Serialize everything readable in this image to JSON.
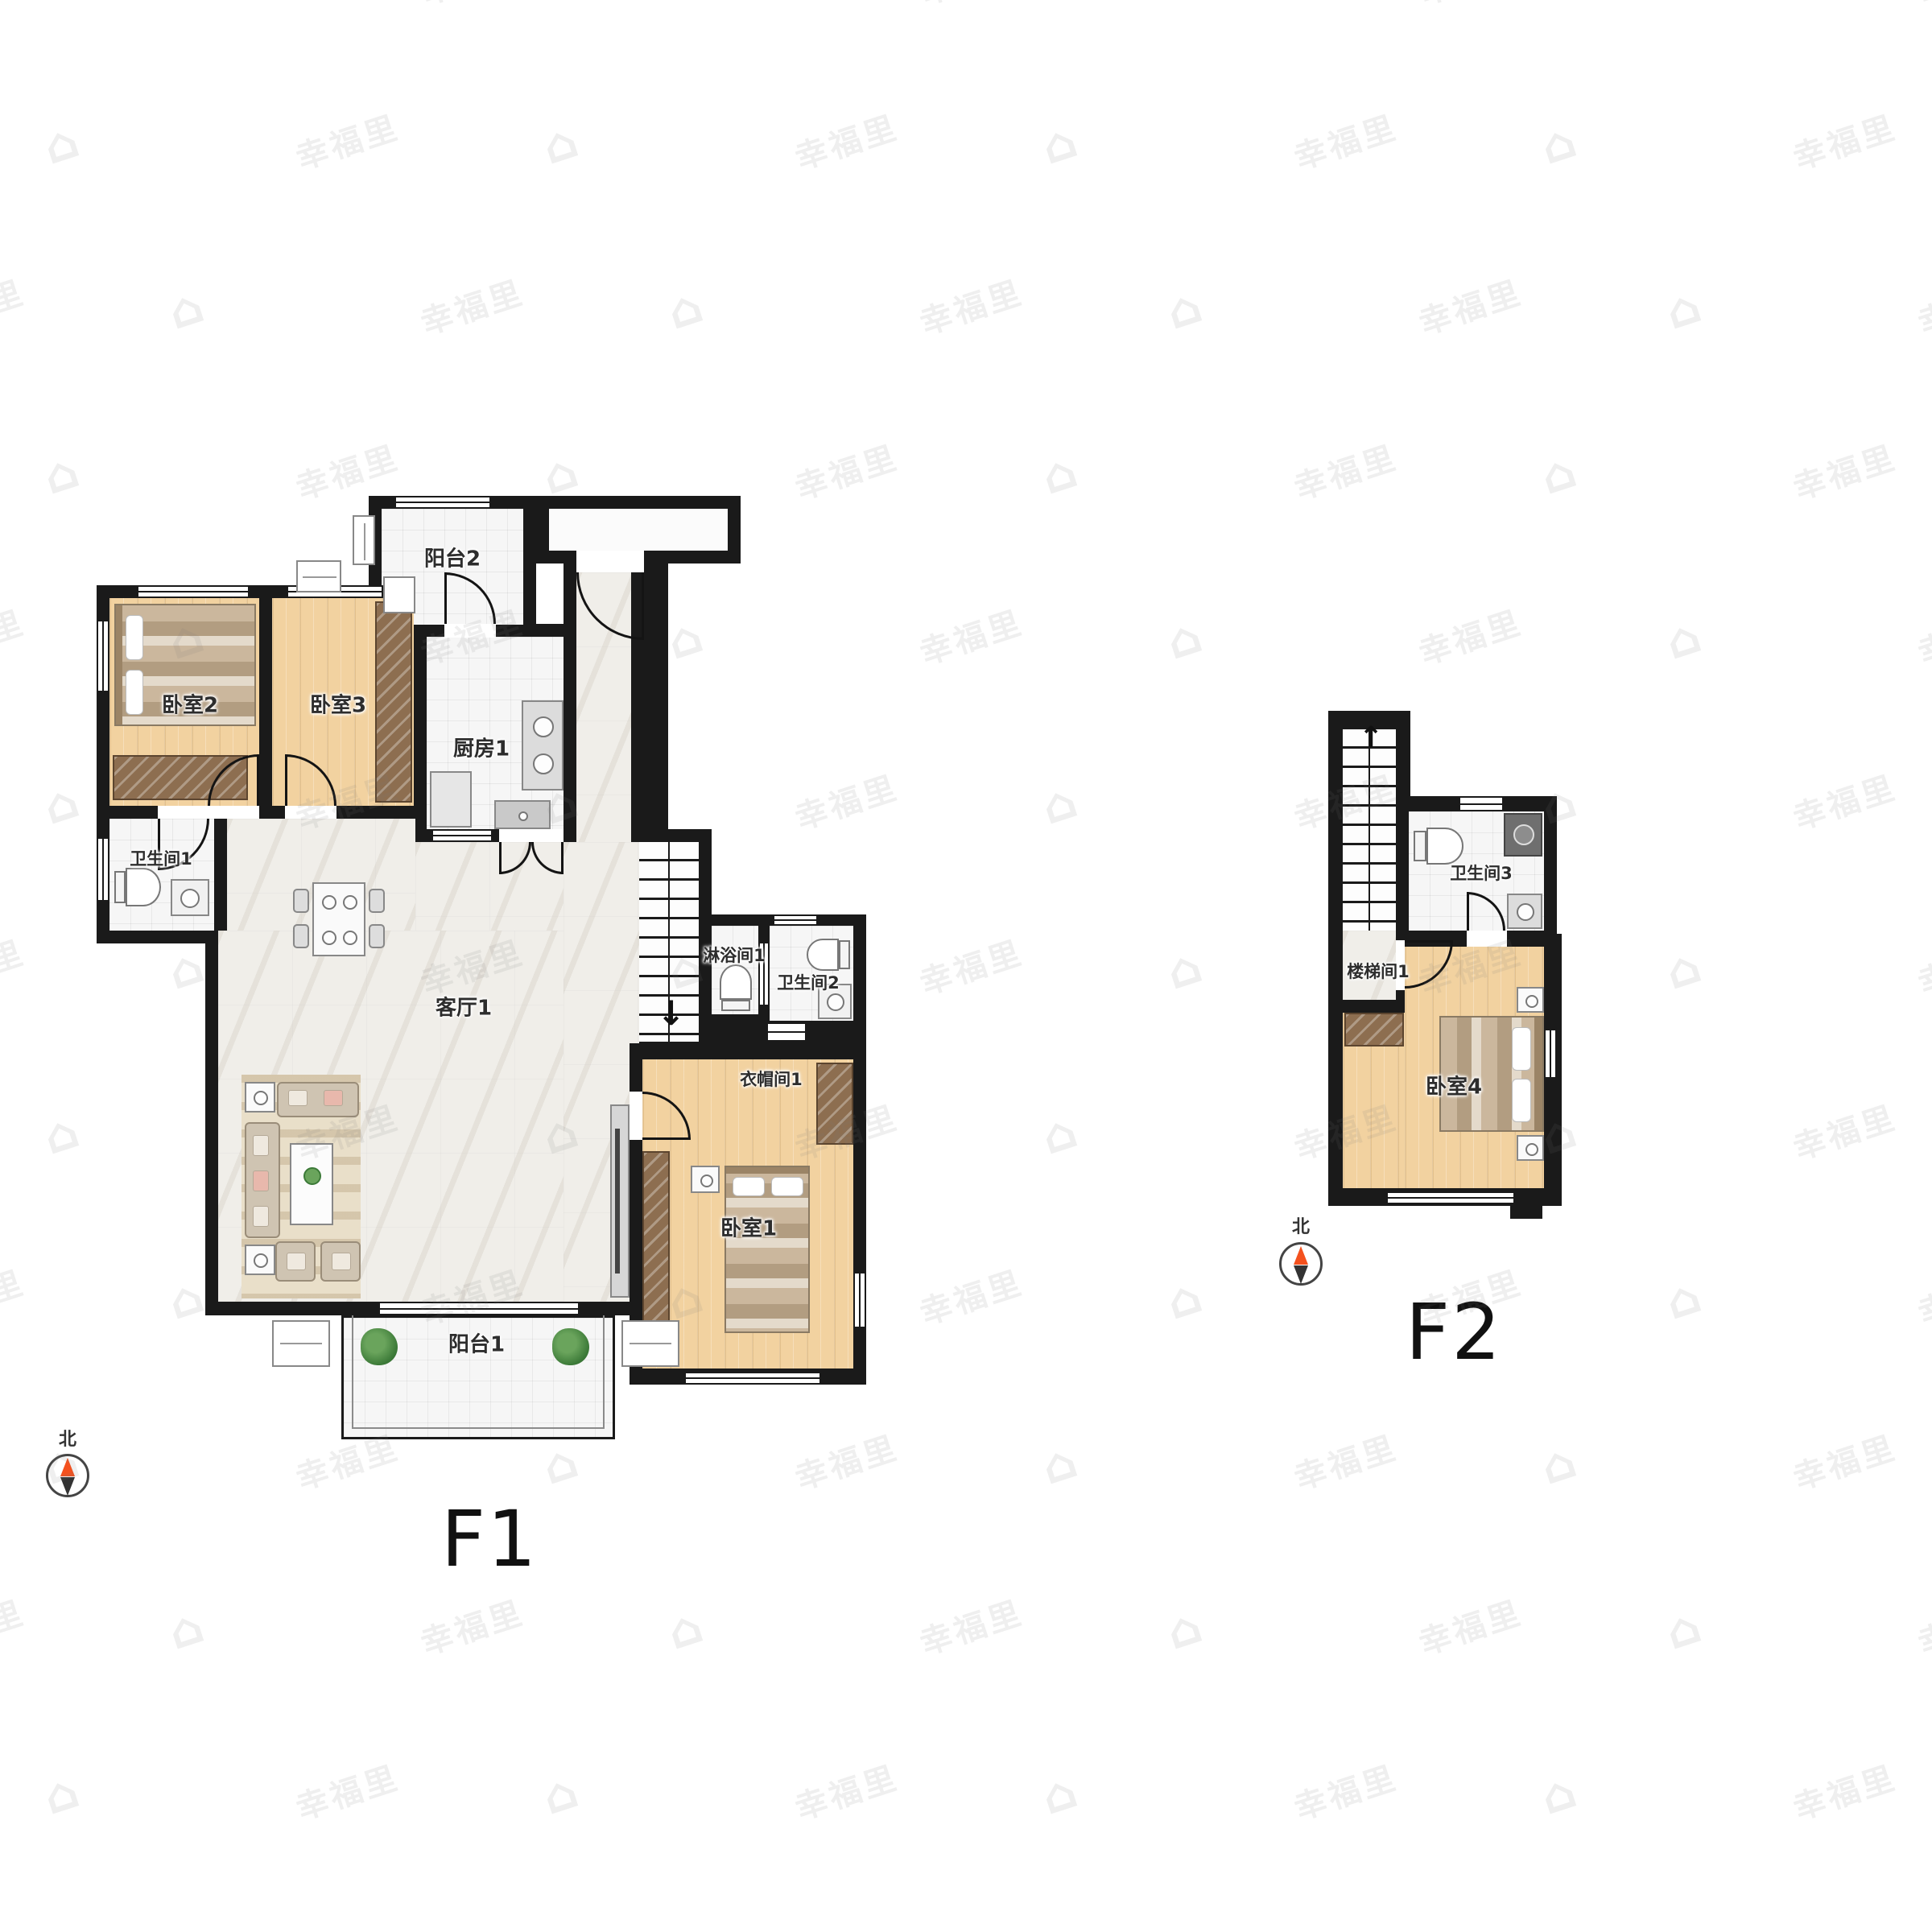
{
  "watermark": {
    "text": "幸福里"
  },
  "f1": {
    "label": "F1",
    "compass": "北",
    "rooms": {
      "balcony2": "阳台2",
      "bedroom2": "卧室2",
      "bedroom3": "卧室3",
      "kitchen1": "厨房1",
      "bathroom1": "卫生间1",
      "living1": "客厅1",
      "shower1": "淋浴间1",
      "bathroom2": "卫生间2",
      "cloakroom1": "衣帽间1",
      "bedroom1": "卧室1",
      "balcony1": "阳台1"
    }
  },
  "f2": {
    "label": "F2",
    "compass": "北",
    "rooms": {
      "bathroom3": "卫生间3",
      "stairwell1": "楼梯间1",
      "bedroom4": "卧室4"
    }
  }
}
